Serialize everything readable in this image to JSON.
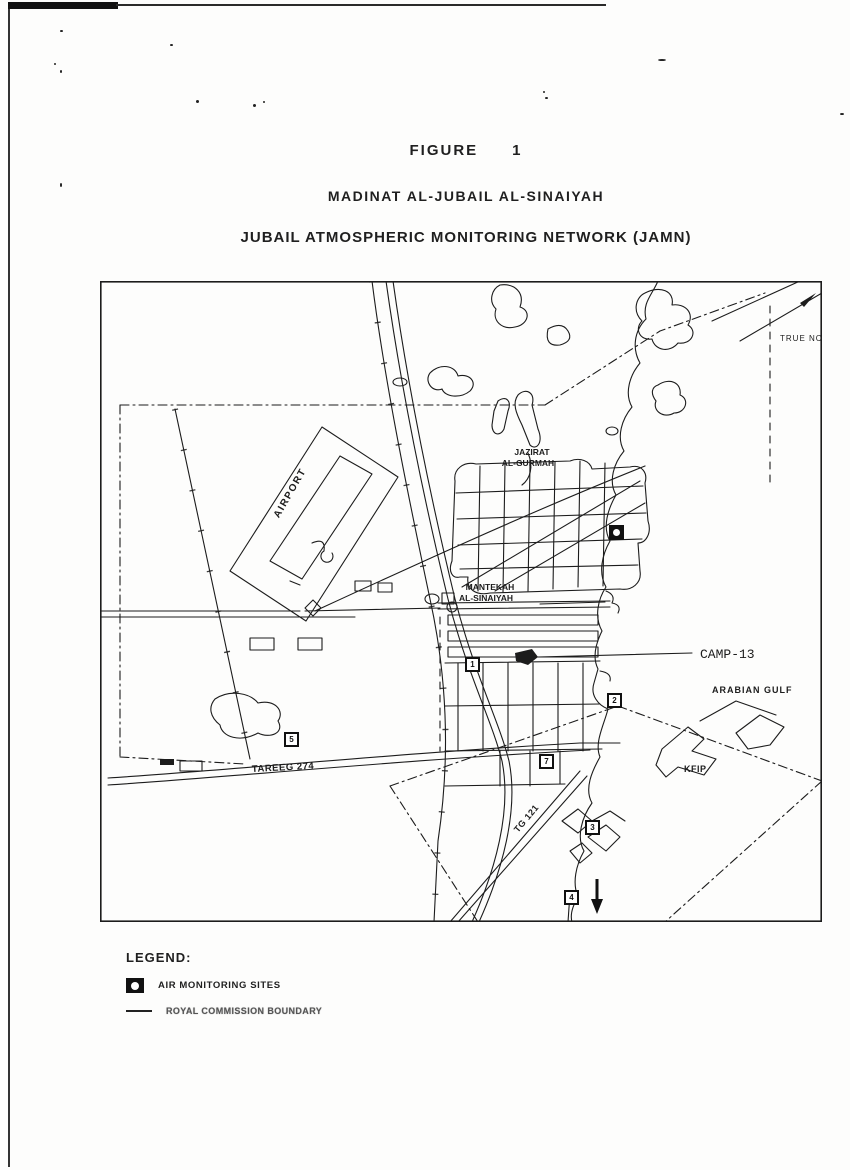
{
  "page": {
    "figure_label": "FIGURE",
    "figure_number": "1",
    "subtitle": "MADINAT AL-JUBAIL AL-SINAIYAH",
    "title": "JUBAIL ATMOSPHERIC MONITORING NETWORK (JAMN)"
  },
  "map": {
    "ink_color": "#1c1c1c",
    "labels": {
      "airport": "AIRPORT",
      "jazirat_line1": "JAZIRAT",
      "jazirat_line2": "AL-GURMAH",
      "mantekah_line1": "MANTEKAH",
      "mantekah_line2": "AL-SINAIYAH",
      "camp13": "CAMP-13",
      "arabian_gulf": "ARABIAN GULF",
      "tareeg_274": "TAREEG 274",
      "kfip": "KFIP",
      "tg_121": "TG 121",
      "true_north": "TRUE NC"
    },
    "monitoring_sites": [
      {
        "number": "",
        "x": 517,
        "y": 252,
        "style": "filled"
      },
      {
        "number": "1",
        "x": 373,
        "y": 384,
        "style": "outline"
      },
      {
        "number": "2",
        "x": 515,
        "y": 420,
        "style": "outline"
      },
      {
        "number": "5",
        "x": 192,
        "y": 459,
        "style": "outline"
      },
      {
        "number": "7",
        "x": 447,
        "y": 481,
        "style": "outline"
      },
      {
        "number": "3",
        "x": 493,
        "y": 547,
        "style": "outline"
      },
      {
        "number": "4",
        "x": 472,
        "y": 617,
        "style": "outline"
      }
    ]
  },
  "legend": {
    "heading": "LEGEND:",
    "items": [
      {
        "icon": "air-monitoring-site-icon",
        "label": "AIR MONITORING SITES"
      },
      {
        "icon": "boundary-line-icon",
        "label": "ROYAL COMMISSION BOUNDARY"
      }
    ]
  }
}
